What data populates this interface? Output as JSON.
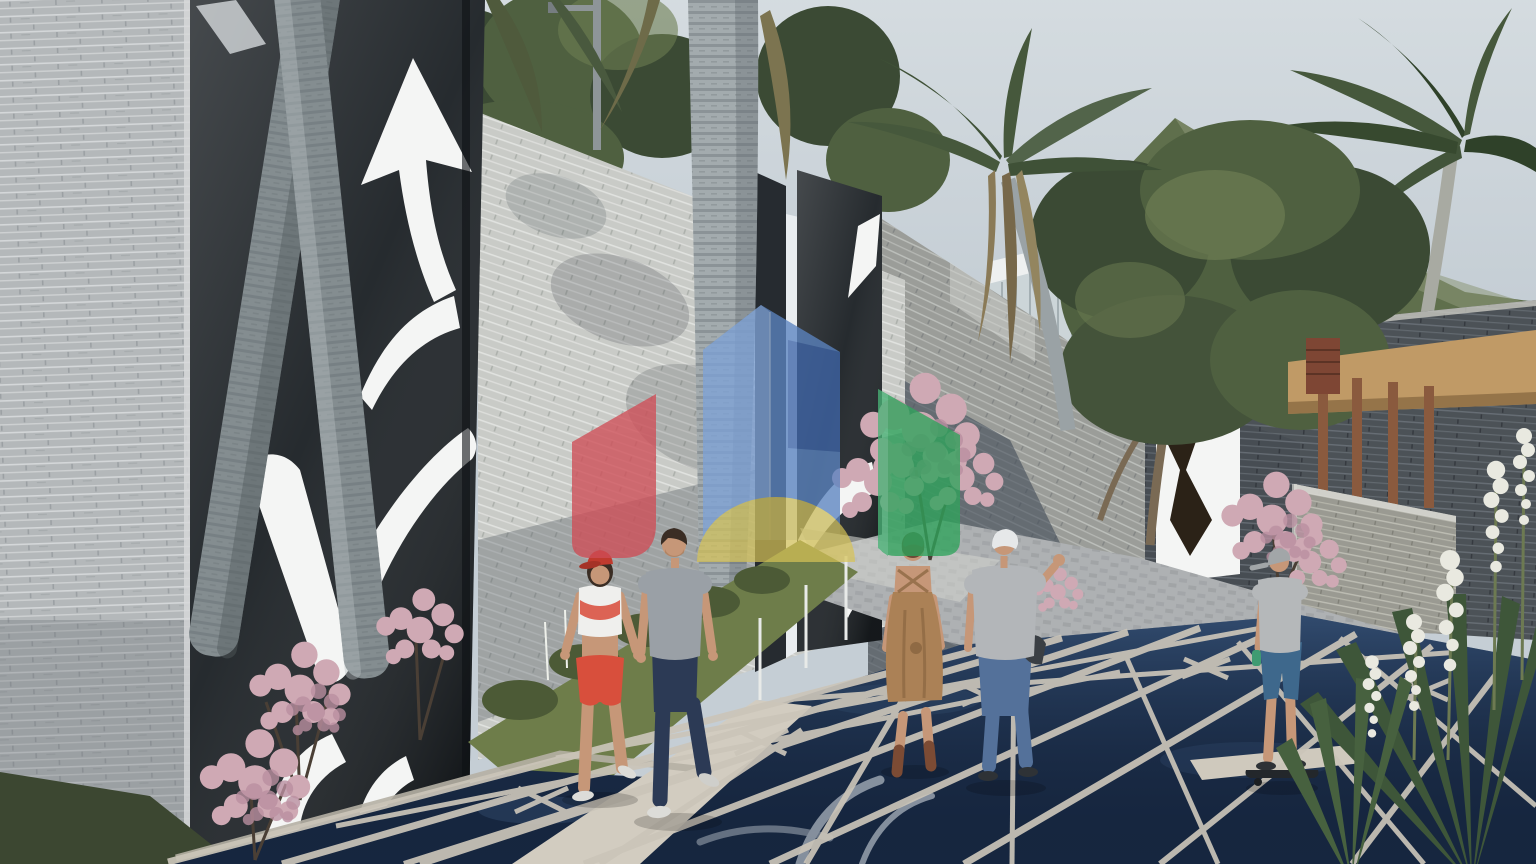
{
  "scene": {
    "kind": "architectural-exterior-render",
    "elements": [
      "sky",
      "mountain",
      "background-trees",
      "palm-trees",
      "stone-walls",
      "black-art-panels-with-white-cutouts",
      "mirror-gate",
      "glass-pavilion",
      "wood-pergola",
      "flower-bushes",
      "grass",
      "water-feature-star-walkway",
      "pedestrian-couple",
      "woman-in-dress",
      "man-in-cap",
      "boy-on-skateboard",
      "house-logo-watermark"
    ]
  },
  "watermark": {
    "shapes": [
      {
        "name": "red-gable"
      },
      {
        "name": "blue-tower"
      },
      {
        "name": "yellow-dome"
      },
      {
        "name": "green-gable"
      }
    ]
  },
  "colors": {
    "sky": "#c5ced5",
    "mountain": "#5f6f4c",
    "mountain_far": "#8c9878",
    "tree_dark": "#3b4a34",
    "tree_mid": "#4f6040",
    "tree_light": "#6d7d52",
    "palm_green": "#46583c",
    "palm_brown": "#8a7a57",
    "trunk_light": "#a3abae",
    "trunk_dark": "#848d90",
    "wall_light": "#b4b8ba",
    "wall_sun": "#c9cbc7",
    "wall_mid": "#9b9d99",
    "wall_dark": "#474d53",
    "wall_far": "#4c5257",
    "low_wall": "#9a9a92",
    "panel_black": "#1d2226",
    "cutout_white": "#f4f5f4",
    "mirror": "#e9edf0",
    "glass": "#ccd5d8",
    "frame_white": "#eef0f0",
    "pergola_wood": "#8a5a3e",
    "pergola_thatch": "#c09a66",
    "louver": "#7e4634",
    "pavement": "#aeb1b3",
    "pavement_light": "#cfd0cb",
    "grass": "#6e7d4a",
    "grass_dark": "#4c5a36",
    "blossom_pink": "#cfa9b4",
    "blossom_deep": "#b98fa0",
    "water_deep": "#16263f",
    "water_mid": "#30486a",
    "reflection": "#dfe5ea",
    "lattice": "#cbc5b9",
    "yucca": "#3e5639",
    "yucca_flower": "#e9e9e0",
    "skin": "#c69778",
    "hair_dark": "#3a2d24",
    "w1_cap": "#c03a2e",
    "w1_top": "#efefed",
    "w1_accent": "#d84a38",
    "w1_shorts": "#d84f3c",
    "m1_shirt": "#9aa0a6",
    "m1_jeans": "#2c3a55",
    "shoe_white": "#dcdcd8",
    "w2_dress": "#ab8156",
    "w2_boots": "#7c4b34",
    "w2_cap": "#5c6149",
    "w2_hair": "#6b4a35",
    "m2_cap": "#e6e8e9",
    "m2_shirt": "#b3b6b9",
    "m2_jeans": "#54719a",
    "boy_cap": "#a2a6a8",
    "boy_shirt": "#b5b8ba",
    "boy_shorts": "#3e688c",
    "board": "#23272b",
    "logo_red": "#cf4e57",
    "logo_blue": "#5c84c0",
    "logo_blue_light": "#7ea2d6",
    "logo_blue_dark": "#3f66a8",
    "logo_yellow": "#d7c355",
    "logo_green": "#2fa35b",
    "logo_green_light": "#49b377"
  }
}
